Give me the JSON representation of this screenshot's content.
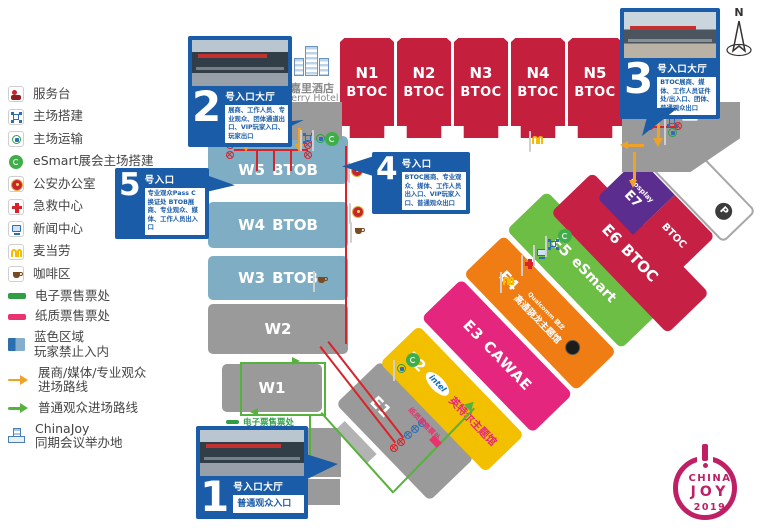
{
  "legend": {
    "items": [
      {
        "label": "服务台"
      },
      {
        "label": "主场搭建"
      },
      {
        "label": "主场运输"
      },
      {
        "label": "eSmart展会主场搭建"
      },
      {
        "label": "公安办公室"
      },
      {
        "label": "急救中心"
      },
      {
        "label": "新闻中心"
      },
      {
        "label": "麦当劳"
      },
      {
        "label": "咖啡区"
      },
      {
        "label": "电子票售票处"
      },
      {
        "label": "纸质票售票处"
      },
      {
        "label": "蓝色区域",
        "label2": "玩家禁止入内"
      },
      {
        "label": "展商/媒体/专业观众",
        "label2": "进场路线"
      },
      {
        "label": "普通观众进场路线"
      },
      {
        "label": "ChinaJoy",
        "label2": "同期会议举办地"
      }
    ]
  },
  "entrances": {
    "no1": {
      "num": "1",
      "title": "号入口大厅",
      "desc": "普通观众入口"
    },
    "no2": {
      "num": "2",
      "title": "号入口大厅",
      "desc": "展商、工作人员、专业观众、团体通道出口、VIP玩家入口、玩家出口"
    },
    "no3": {
      "num": "3",
      "title": "号入口大厅",
      "desc": "BTOC展商、媒体、工作人员证件处/出入口、团体、普通观众出口"
    },
    "no4": {
      "num": "4",
      "title": "号入口",
      "desc": "BTOC展商、专业观众、媒体、工作人员出入口、VIP玩家入口、普通观众出口"
    },
    "no5": {
      "num": "5",
      "title": "号入口",
      "desc": "专业观众Pass C换证处 BTOB展商、专业观众、媒体、工作人员出入口"
    }
  },
  "halls": {
    "north": [
      {
        "id": "N1",
        "sub": "BTOC"
      },
      {
        "id": "N2",
        "sub": "BTOC"
      },
      {
        "id": "N3",
        "sub": "BTOC"
      },
      {
        "id": "N4",
        "sub": "BTOC"
      },
      {
        "id": "N5",
        "sub": "BTOC"
      }
    ],
    "west": [
      {
        "id": "W5",
        "sub": "BTOB"
      },
      {
        "id": "W4",
        "sub": "BTOB"
      },
      {
        "id": "W3",
        "sub": "BTOB"
      },
      {
        "id": "W2"
      },
      {
        "id": "W1"
      }
    ],
    "east": {
      "e1": {
        "id": "E1"
      },
      "e2": {
        "id": "E2",
        "brand": "intel",
        "theme": "英特尔主题馆"
      },
      "e3": {
        "id": "E3",
        "sub": "CAWAE"
      },
      "e4": {
        "id": "E4",
        "brand": "Qualcomm 骁龙",
        "theme": "高通骁龙主题馆"
      },
      "e5": {
        "id": "E5",
        "sub": "eSmart"
      },
      "e6": {
        "id": "E6",
        "sub": "BTOC"
      },
      "e7": {
        "id": "E7",
        "sub": "Cosplay",
        "ext": "BTOC"
      }
    }
  },
  "landmarks": {
    "hotel_cn": "嘉里酒店",
    "hotel_en": "Kerry Hotel",
    "p1": "P1",
    "p": "P",
    "compass": "N"
  },
  "labels": {
    "eticket": "电子票售票处",
    "paper_ticket": "纸质票售票处"
  },
  "logo": {
    "top": "CHINA",
    "mid": "JOY",
    "year": "2019"
  },
  "colors": {
    "callout_blue": "#1b5ca8",
    "hall_red": "#c4203e",
    "hall_blue": "#7fadc4",
    "hall_gray": "#9a9a9a",
    "e2_yellow": "#f3c000",
    "e3_magenta": "#e4267e",
    "e4_orange": "#ef7d13",
    "e5_green": "#6cbe45",
    "e7_purple": "#5b2d8e",
    "route_orange": "#f0a226",
    "route_green": "#56b23c",
    "route_red": "#d9232a",
    "logo_magenta": "#bf2065"
  }
}
